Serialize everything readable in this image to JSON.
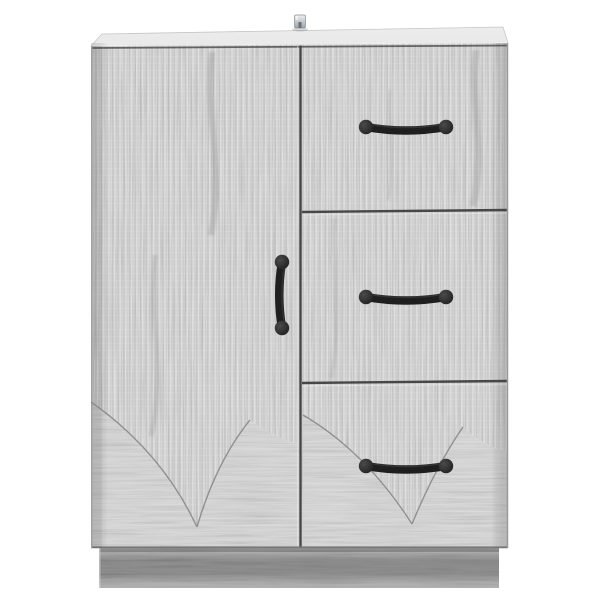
{
  "scene": {
    "description": "Studio product photo of a grey oak-finish cabinet with one left-hand door and three right-hand drawers, standing on a recessed plinth base against a plain white background",
    "background_color": "#ffffff"
  },
  "cabinet": {
    "finish": "grey sonoma oak woodgrain with vertical fluted ridges and swirl grain near the base",
    "parts": {
      "top_panel": "thin overhanging top with visible upper surface",
      "metal_fitting": "small silver anti-tip wall bracket on top centre",
      "door": {
        "position": "left, full height",
        "handle": "vertical black bar pull with round ends"
      },
      "drawer_count": 3,
      "drawers": [
        {
          "position": "top right",
          "handle": "horizontal black bar pull with round ends"
        },
        {
          "position": "middle right",
          "handle": "horizontal black bar pull with round ends"
        },
        {
          "position": "bottom right",
          "handle": "horizontal black bar pull with round ends"
        }
      ],
      "plinth": "recessed darker grey base strip",
      "decoration": "etched V-shaped curved grain arcs near the bottom of the door and of the bottom drawer"
    },
    "colors": {
      "background": "#ffffff",
      "wood_base": "#d8d8d8",
      "wood_light": "#ececec",
      "wood_dark": "#b3b3b3",
      "swirl_base": "#d6d6d6",
      "top_panel": "#e9e9e9",
      "seam": "#474747",
      "edge": "#9a9a9a",
      "arc_line": "#898989",
      "plinth_base": "#bdbdbd",
      "plinth_dark": "#8e8e8e",
      "handle_dark": "#1f1f1f",
      "handle_mid": "#4a4a4a",
      "metal_light": "#eef1f3",
      "metal_dark": "#9ba4ab"
    }
  }
}
